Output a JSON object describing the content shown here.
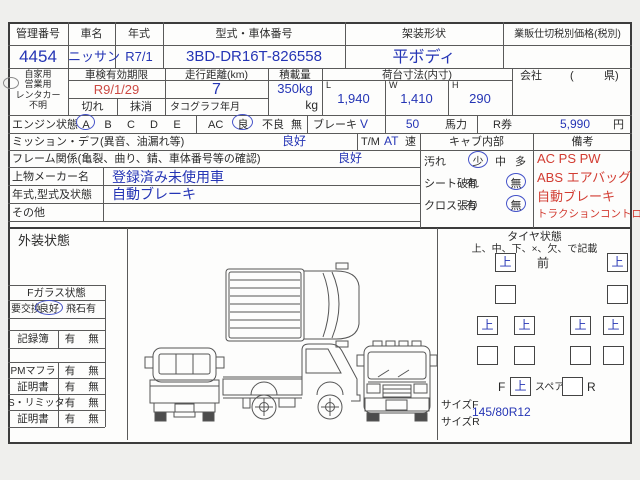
{
  "header_row": {
    "cols": [
      {
        "label": "管理番号",
        "value": "4454"
      },
      {
        "label": "車名",
        "value": "ニッサン"
      },
      {
        "label": "年式",
        "value": "R7/1"
      },
      {
        "label": "型式・車体番号",
        "value": "3BD-DR16T-826558"
      },
      {
        "label": "架装形状",
        "value": "平ボディ"
      },
      {
        "label": "業販仕切税別価格(税別)",
        "value": ""
      }
    ]
  },
  "row2": {
    "usage": {
      "opt1": "自家用",
      "opt2": "営業用",
      "opt3": "レンタカー",
      "opt4": "不明"
    },
    "shaken": {
      "label": "車検有効期限",
      "value": "R9/1/29",
      "opt1": "切れ",
      "opt2": "抹消"
    },
    "mileage": {
      "label": "走行距離(km)",
      "value": "7",
      "sub": "タコグラフ年月"
    },
    "payload": {
      "label": "積載量",
      "value": "350kg",
      "unit": "kg"
    },
    "bed": {
      "label": "荷台寸法(内寸)",
      "l": "L",
      "l_v": "1,940",
      "w": "W",
      "w_v": "1,410",
      "h": "H",
      "h_v": "290"
    },
    "company": {
      "label": "会社",
      "open": "(",
      "close": "県)"
    }
  },
  "engine": {
    "label": "エンジン状態",
    "a": "A",
    "b": "B",
    "c": "C",
    "d": "D",
    "e": "E",
    "ac": "AC",
    "good": "良",
    "bad": "不良",
    "none": "無",
    "brake": "ブレーキ",
    "brake_v": "V",
    "hp_v": "50",
    "hp": "馬力",
    "rken": "R券",
    "rken_v": "5,990",
    "yen": "円"
  },
  "mission": {
    "label": "ミッション・デフ(異音、油漏れ等)",
    "value": "良好",
    "tm": "T/M",
    "tm_v": "AT",
    "tm_u": "速"
  },
  "cab": {
    "header": "キャブ内部",
    "dirt": "汚れ",
    "dirt_1": "少",
    "dirt_2": "中",
    "dirt_3": "多",
    "seat": "シート破れ",
    "seat_1": "有",
    "seat_2": "無",
    "cloth": "クロス張り",
    "cloth_1": "有",
    "cloth_2": "無"
  },
  "remarks": {
    "header": "備考",
    "line1": "AC PS PW",
    "line2": "ABS エアバッグ",
    "line3": "自動ブレーキ",
    "line4": "トラクションコントロール"
  },
  "frame": {
    "label": "フレーム関係(亀裂、曲り、錆、車体番号等の確認)",
    "value": "良好"
  },
  "maker": {
    "label": "上物メーカー名",
    "value": "登録済み未使用車"
  },
  "model": {
    "label": "年式,型式及状態",
    "value": "自動ブレーキ"
  },
  "other": {
    "label": "その他",
    "value": ""
  },
  "exterior": {
    "label": "外装状態"
  },
  "glass": {
    "header": "Fガラス状態",
    "opt1": "要交換",
    "opt2": "良好",
    "opt3": "飛石有",
    "rows": [
      {
        "label": "記録簿",
        "y": "有",
        "n": "無"
      },
      {
        "label": "PMマフラ",
        "y": "有",
        "n": "無"
      },
      {
        "label": "証明書",
        "y": "有",
        "n": "無"
      },
      {
        "label": "S・リミッタ",
        "y": "有",
        "n": "無"
      },
      {
        "label": "証明書",
        "y": "有",
        "n": "無"
      }
    ]
  },
  "tires": {
    "title": "タイヤ状態",
    "subtitle": "上、中、下、×、欠、で記載",
    "front": "前",
    "fl": "上",
    "fr": "上",
    "r2_1": "",
    "r2_2": "",
    "r3_1": "上",
    "r3_2": "上",
    "r3_3": "上",
    "r3_4": "上",
    "r4_1": "",
    "r4_2": "",
    "r4_3": "",
    "r4_4": "",
    "f_label": "F",
    "f_v": "上",
    "spare": "スペア",
    "spare_v": "",
    "r_label": "R",
    "size_f": "サイズF",
    "size_f_v": "145/80R12",
    "size_r": "サイズR",
    "size_r_v": ""
  }
}
